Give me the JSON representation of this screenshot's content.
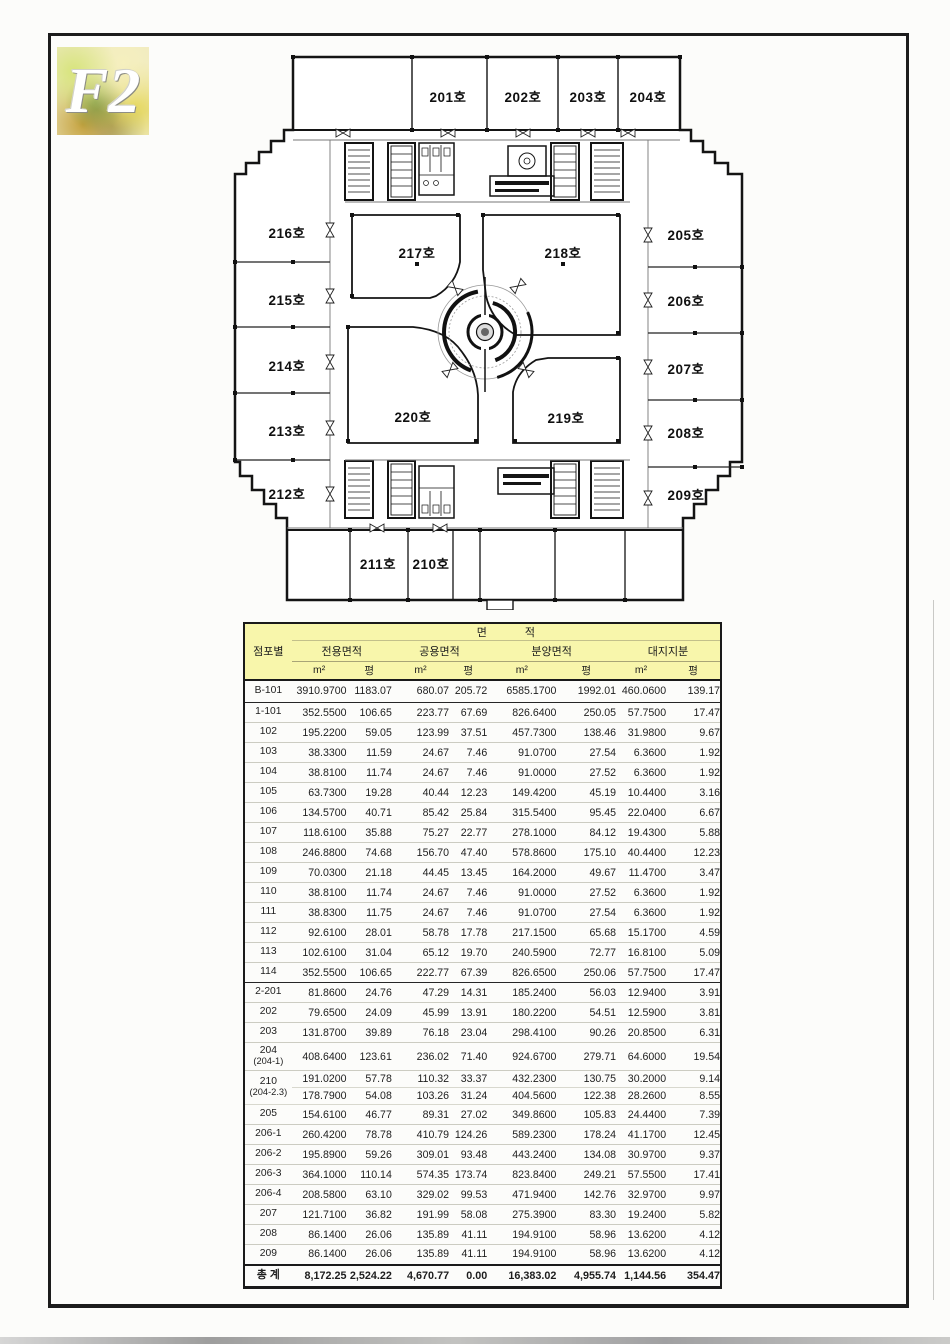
{
  "document": {
    "floor_code": "F2"
  },
  "floorplan": {
    "rooms": [
      {
        "label": "201호"
      },
      {
        "label": "202호"
      },
      {
        "label": "203호"
      },
      {
        "label": "204호"
      },
      {
        "label": "205호"
      },
      {
        "label": "206호"
      },
      {
        "label": "207호"
      },
      {
        "label": "208호"
      },
      {
        "label": "209호"
      },
      {
        "label": "210호"
      },
      {
        "label": "211호"
      },
      {
        "label": "212호"
      },
      {
        "label": "213호"
      },
      {
        "label": "214호"
      },
      {
        "label": "215호"
      },
      {
        "label": "216호"
      },
      {
        "label": "217호"
      },
      {
        "label": "218호"
      },
      {
        "label": "219호"
      },
      {
        "label": "220호"
      }
    ]
  },
  "table": {
    "header": {
      "store": "점포별",
      "area_1": "면",
      "area_2": "적",
      "groups": [
        "전용면적",
        "공용면적",
        "분양면적",
        "대지지분"
      ],
      "unit_area": "m²",
      "unit_pyeong": "평"
    },
    "rows": [
      {
        "label": "B-101",
        "h": "b101",
        "end": true,
        "cells": [
          "3910.9700",
          "1183.07",
          "680.07",
          "205.72",
          "6585.1700",
          "1992.01",
          "460.0600",
          "139.17"
        ]
      },
      {
        "label": "1-101",
        "cells": [
          "352.5500",
          "106.65",
          "223.77",
          "67.69",
          "826.6400",
          "250.05",
          "57.7500",
          "17.47"
        ]
      },
      {
        "label": "102",
        "cells": [
          "195.2200",
          "59.05",
          "123.99",
          "37.51",
          "457.7300",
          "138.46",
          "31.9800",
          "9.67"
        ]
      },
      {
        "label": "103",
        "cells": [
          "38.3300",
          "11.59",
          "24.67",
          "7.46",
          "91.0700",
          "27.54",
          "6.3600",
          "1.92"
        ]
      },
      {
        "label": "104",
        "cells": [
          "38.8100",
          "11.74",
          "24.67",
          "7.46",
          "91.0000",
          "27.52",
          "6.3600",
          "1.92"
        ]
      },
      {
        "label": "105",
        "cells": [
          "63.7300",
          "19.28",
          "40.44",
          "12.23",
          "149.4200",
          "45.19",
          "10.4400",
          "3.16"
        ]
      },
      {
        "label": "106",
        "cells": [
          "134.5700",
          "40.71",
          "85.42",
          "25.84",
          "315.5400",
          "95.45",
          "22.0400",
          "6.67"
        ]
      },
      {
        "label": "107",
        "cells": [
          "118.6100",
          "35.88",
          "75.27",
          "22.77",
          "278.1000",
          "84.12",
          "19.4300",
          "5.88"
        ]
      },
      {
        "label": "108",
        "cells": [
          "246.8800",
          "74.68",
          "156.70",
          "47.40",
          "578.8600",
          "175.10",
          "40.4400",
          "12.23"
        ]
      },
      {
        "label": "109",
        "cells": [
          "70.0300",
          "21.18",
          "44.45",
          "13.45",
          "164.2000",
          "49.67",
          "11.4700",
          "3.47"
        ]
      },
      {
        "label": "110",
        "cells": [
          "38.8100",
          "11.74",
          "24.67",
          "7.46",
          "91.0000",
          "27.52",
          "6.3600",
          "1.92"
        ]
      },
      {
        "label": "111",
        "cells": [
          "38.8300",
          "11.75",
          "24.67",
          "7.46",
          "91.0700",
          "27.54",
          "6.3600",
          "1.92"
        ]
      },
      {
        "label": "112",
        "cells": [
          "92.6100",
          "28.01",
          "58.78",
          "17.78",
          "217.1500",
          "65.68",
          "15.1700",
          "4.59"
        ]
      },
      {
        "label": "113",
        "cells": [
          "102.6100",
          "31.04",
          "65.12",
          "19.70",
          "240.5900",
          "72.77",
          "16.8100",
          "5.09"
        ]
      },
      {
        "label": "114",
        "end": true,
        "cells": [
          "352.5500",
          "106.65",
          "222.77",
          "67.39",
          "826.6500",
          "250.06",
          "57.7500",
          "17.47"
        ]
      },
      {
        "label": "2-201",
        "cells": [
          "81.8600",
          "24.76",
          "47.29",
          "14.31",
          "185.2400",
          "56.03",
          "12.9400",
          "3.91"
        ]
      },
      {
        "label": "202",
        "cells": [
          "79.6500",
          "24.09",
          "45.99",
          "13.91",
          "180.2200",
          "54.51",
          "12.5900",
          "3.81"
        ]
      },
      {
        "label": "203",
        "cells": [
          "131.8700",
          "39.89",
          "76.18",
          "23.04",
          "298.4100",
          "90.26",
          "20.8500",
          "6.31"
        ]
      },
      {
        "label": "204",
        "sublabel": "(204-1)",
        "h": "tall",
        "cells": [
          "408.6400",
          "123.61",
          "236.02",
          "71.40",
          "924.6700",
          "279.71",
          "64.6000",
          "19.54"
        ]
      },
      {
        "label": "210",
        "sublabel": "(204-2.3)",
        "cells": [
          "191.0200",
          "57.78",
          "110.32",
          "33.37",
          "432.2300",
          "130.75",
          "30.2000",
          "9.14"
        ],
        "cells2": [
          "178.7900",
          "54.08",
          "103.26",
          "31.24",
          "404.5600",
          "122.38",
          "28.2600",
          "8.55"
        ]
      },
      {
        "label": "205",
        "cells": [
          "154.6100",
          "46.77",
          "89.31",
          "27.02",
          "349.8600",
          "105.83",
          "24.4400",
          "7.39"
        ]
      },
      {
        "label": "206-1",
        "cells": [
          "260.4200",
          "78.78",
          "410.79",
          "124.26",
          "589.2300",
          "178.24",
          "41.1700",
          "12.45"
        ]
      },
      {
        "label": "206-2",
        "cells": [
          "195.8900",
          "59.26",
          "309.01",
          "93.48",
          "443.2400",
          "134.08",
          "30.9700",
          "9.37"
        ]
      },
      {
        "label": "206-3",
        "cells": [
          "364.1000",
          "110.14",
          "574.35",
          "173.74",
          "823.8400",
          "249.21",
          "57.5500",
          "17.41"
        ]
      },
      {
        "label": "206-4",
        "cells": [
          "208.5800",
          "63.10",
          "329.02",
          "99.53",
          "471.9400",
          "142.76",
          "32.9700",
          "9.97"
        ]
      },
      {
        "label": "207",
        "cells": [
          "121.7100",
          "36.82",
          "191.99",
          "58.08",
          "275.3900",
          "83.30",
          "19.2400",
          "5.82"
        ]
      },
      {
        "label": "208",
        "cells": [
          "86.1400",
          "26.06",
          "135.89",
          "41.11",
          "194.9100",
          "58.96",
          "13.6200",
          "4.12"
        ]
      },
      {
        "label": "209",
        "end": true,
        "cells": [
          "86.1400",
          "26.06",
          "135.89",
          "41.11",
          "194.9100",
          "58.96",
          "13.6200",
          "4.12"
        ]
      }
    ],
    "total": {
      "label": "총 계",
      "cells": [
        "8,172.25",
        "2,524.22",
        "4,670.77",
        "0.00",
        "16,383.02",
        "4,955.74",
        "1,144.56",
        "354.47"
      ]
    }
  }
}
